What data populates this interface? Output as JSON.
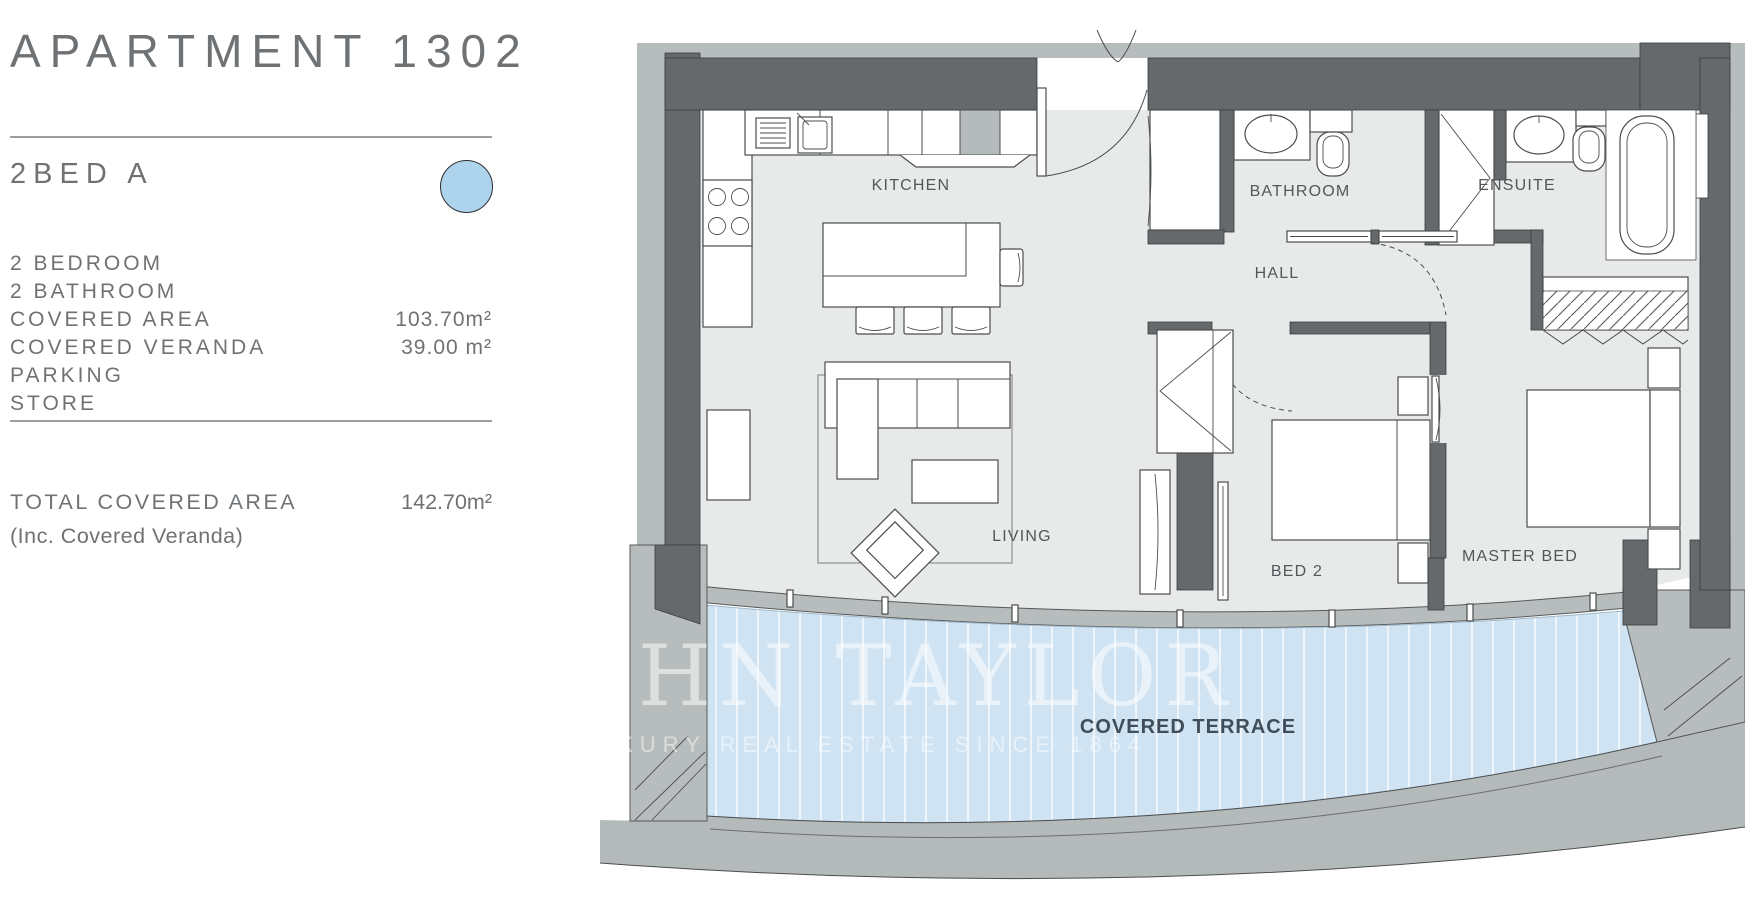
{
  "panel": {
    "title": "APARTMENT 1302",
    "unit_type": "2BED A",
    "accent_color": "#aed3ec",
    "details": [
      {
        "label": "2 BEDROOM",
        "value": ""
      },
      {
        "label": "2 BATHROOM",
        "value": ""
      },
      {
        "label": "COVERED AREA",
        "value": "103.70m²"
      },
      {
        "label": "COVERED VERANDA",
        "value": "39.00 m²"
      },
      {
        "label": "PARKING",
        "value": ""
      },
      {
        "label": "STORE",
        "value": ""
      }
    ],
    "total_label": "TOTAL COVERED AREA",
    "total_value": "142.70m²",
    "total_note": "(Inc. Covered Veranda)"
  },
  "plan": {
    "rooms": {
      "kitchen": "KITCHEN",
      "bathroom": "BATHROOM",
      "ensuite": "ENSUITE",
      "hall": "HALL",
      "living": "LIVING",
      "bed2": "BED 2",
      "master_bed": "MASTER BED",
      "covered_terrace": "COVERED TERRACE"
    },
    "watermark": {
      "line1": "HN TAYLOR",
      "line2": "LUXURY REAL ESTATE SINCE 1864"
    },
    "colors": {
      "wall": "#66696b",
      "floor": "#e8e9e9",
      "trim": "#b7bcbc",
      "terrace_blue": "#cfe3f3"
    }
  }
}
